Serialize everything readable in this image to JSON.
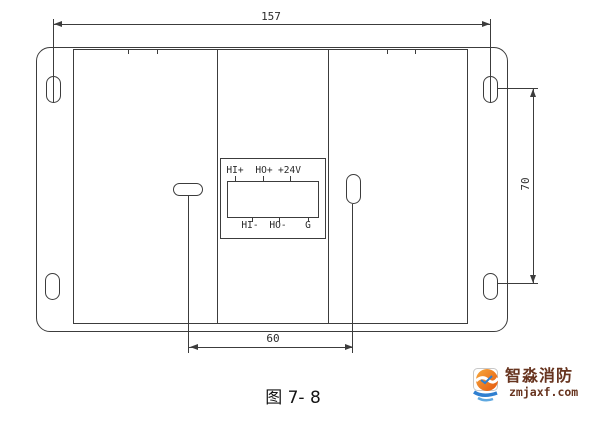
{
  "diagram": {
    "caption": "图 7- 8",
    "dimensions": {
      "overall_width": "157",
      "mount_hole_vertical_spacing": "70",
      "slot_spacing": "60"
    },
    "terminal_block": {
      "top_labels": [
        "HI+",
        "HO+",
        "+24V"
      ],
      "bottom_labels": [
        "HI-",
        "HO-",
        "G"
      ]
    },
    "watermark": {
      "brand": "智淼消防",
      "site": "zmjaxf.com"
    },
    "colors": {
      "line": "#3c3c3c",
      "caption_text": "#141414",
      "watermark_text": "#67341f",
      "logo_orange": "#ee7a10",
      "logo_blue": "#2f7fd0",
      "background": "#ffffff"
    }
  }
}
